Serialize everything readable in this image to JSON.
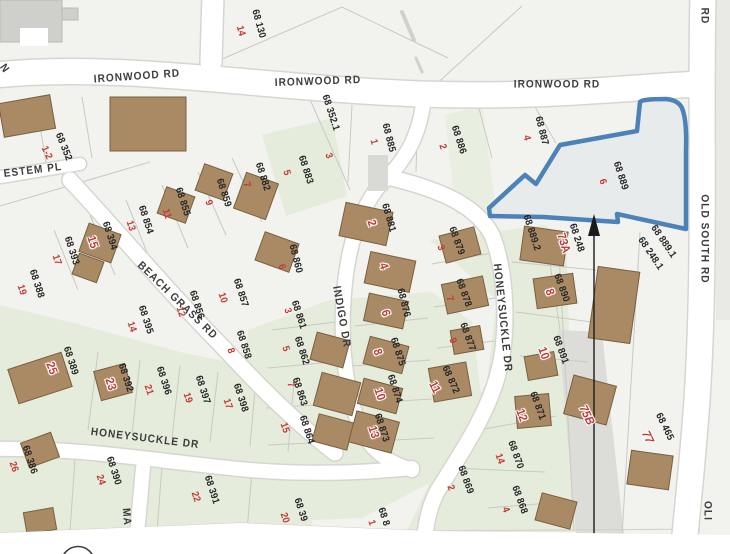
{
  "map": {
    "selected_parcel": {
      "parcel_number": "68 889",
      "house_number": "6"
    },
    "colors": {
      "highlight_blue": "#4d82b8",
      "house_red": "#c13a36",
      "parcel_text": "#262626",
      "street_text": "#3d3d3d",
      "building_brown": "#aa8a64",
      "building_edge": "#77603f",
      "green_area": "#e5ecdb",
      "road_white": "#ffffff",
      "background": "#f2f2ef"
    },
    "streets": [
      {
        "t": "IRONWOOD RD",
        "x": 137,
        "y": 77,
        "r": -4
      },
      {
        "t": "IRONWOOD RD",
        "x": 318,
        "y": 82,
        "r": -2
      },
      {
        "t": "IRONWOOD RD",
        "x": 557,
        "y": 85,
        "r": 0
      },
      {
        "t": "RD",
        "x": 704,
        "y": 16,
        "r": 90
      },
      {
        "t": "OLD SOUTH RD",
        "x": 704,
        "y": 239,
        "r": 90
      },
      {
        "t": "OLI",
        "x": 707,
        "y": 511,
        "r": 90
      },
      {
        "t": "ESTEM PL",
        "x": 33,
        "y": 171,
        "r": -7
      },
      {
        "t": "N",
        "x": 4,
        "y": 69,
        "r": 55
      },
      {
        "t": "BEACH GRASS RD",
        "x": 177,
        "y": 301,
        "r": 44
      },
      {
        "t": "INDIGO DR",
        "x": 341,
        "y": 317,
        "r": 80
      },
      {
        "t": "HONEYSUCKLE DR",
        "x": 145,
        "y": 439,
        "r": 7
      },
      {
        "t": "HONEYSUCKLE DR",
        "x": 502,
        "y": 318,
        "r": 84
      },
      {
        "t": "MA",
        "x": 126,
        "y": 517,
        "r": 85
      }
    ],
    "parcels": [
      {
        "t": "68 130",
        "x": 258,
        "y": 24,
        "r": 75
      },
      {
        "t": "68 352",
        "x": 63,
        "y": 147,
        "r": 68
      },
      {
        "t": "68 352.1",
        "x": 330,
        "y": 113,
        "r": 72
      },
      {
        "t": "68 885",
        "x": 388,
        "y": 138,
        "r": 76
      },
      {
        "t": "68 886",
        "x": 458,
        "y": 140,
        "r": 72
      },
      {
        "t": "68 887",
        "x": 541,
        "y": 131,
        "r": 76
      },
      {
        "t": "68 889",
        "x": 620,
        "y": 176,
        "r": 72
      },
      {
        "t": "68 883",
        "x": 305,
        "y": 170,
        "r": 72
      },
      {
        "t": "68 882",
        "x": 262,
        "y": 177,
        "r": 72
      },
      {
        "t": "68 881",
        "x": 388,
        "y": 218,
        "r": 74
      },
      {
        "t": "68 859",
        "x": 223,
        "y": 193,
        "r": 72
      },
      {
        "t": "68 855",
        "x": 182,
        "y": 202,
        "r": 72
      },
      {
        "t": "68 854",
        "x": 145,
        "y": 220,
        "r": 72
      },
      {
        "t": "68 394",
        "x": 109,
        "y": 236,
        "r": 72
      },
      {
        "t": "68 393",
        "x": 71,
        "y": 251,
        "r": 72
      },
      {
        "t": "68 388",
        "x": 36,
        "y": 284,
        "r": 72
      },
      {
        "t": "68 395",
        "x": 145,
        "y": 320,
        "r": 72
      },
      {
        "t": "68 856",
        "x": 196,
        "y": 305,
        "r": 72
      },
      {
        "t": "68 857",
        "x": 240,
        "y": 293,
        "r": 72
      },
      {
        "t": "68 858",
        "x": 243,
        "y": 345,
        "r": 72
      },
      {
        "t": "68 860",
        "x": 295,
        "y": 259,
        "r": 76
      },
      {
        "t": "68 861",
        "x": 298,
        "y": 315,
        "r": 72
      },
      {
        "t": "68 862",
        "x": 301,
        "y": 351,
        "r": 72
      },
      {
        "t": "68 863",
        "x": 299,
        "y": 392,
        "r": 72
      },
      {
        "t": "68 864",
        "x": 306,
        "y": 430,
        "r": 72
      },
      {
        "t": "68 392",
        "x": 125,
        "y": 378,
        "r": 72
      },
      {
        "t": "68 396",
        "x": 163,
        "y": 381,
        "r": 72
      },
      {
        "t": "68 397",
        "x": 202,
        "y": 390,
        "r": 72
      },
      {
        "t": "68 398",
        "x": 240,
        "y": 398,
        "r": 72
      },
      {
        "t": "68 876",
        "x": 403,
        "y": 303,
        "r": 76
      },
      {
        "t": "68 875",
        "x": 397,
        "y": 352,
        "r": 72
      },
      {
        "t": "68 874",
        "x": 394,
        "y": 389,
        "r": 72
      },
      {
        "t": "68 873",
        "x": 381,
        "y": 428,
        "r": 72
      },
      {
        "t": "68 872",
        "x": 450,
        "y": 380,
        "r": 66
      },
      {
        "t": "68 879",
        "x": 456,
        "y": 241,
        "r": 70
      },
      {
        "t": "68 878",
        "x": 463,
        "y": 293,
        "r": 70
      },
      {
        "t": "68 877",
        "x": 467,
        "y": 337,
        "r": 70
      },
      {
        "t": "68 871",
        "x": 537,
        "y": 406,
        "r": 70
      },
      {
        "t": "68 870",
        "x": 515,
        "y": 455,
        "r": 70
      },
      {
        "t": "68 869",
        "x": 465,
        "y": 480,
        "r": 70
      },
      {
        "t": "68 868",
        "x": 519,
        "y": 500,
        "r": 70
      },
      {
        "t": "68 890",
        "x": 561,
        "y": 288,
        "r": 70
      },
      {
        "t": "68 891",
        "x": 560,
        "y": 350,
        "r": 70
      },
      {
        "t": "68 889.2",
        "x": 531,
        "y": 233,
        "r": 72
      },
      {
        "t": "68 248",
        "x": 576,
        "y": 238,
        "r": 72
      },
      {
        "t": "68 889.1",
        "x": 663,
        "y": 242,
        "r": 56
      },
      {
        "t": "68 248.1",
        "x": 650,
        "y": 254,
        "r": 56
      },
      {
        "t": "68 465",
        "x": 664,
        "y": 427,
        "r": 64
      },
      {
        "t": "68 389",
        "x": 70,
        "y": 361,
        "r": 72
      },
      {
        "t": "68 386",
        "x": 29,
        "y": 460,
        "r": 72
      },
      {
        "t": "68 390",
        "x": 113,
        "y": 471,
        "r": 72
      },
      {
        "t": "68 391",
        "x": 211,
        "y": 490,
        "r": 72
      },
      {
        "t": "68 39",
        "x": 300,
        "y": 510,
        "r": 72
      },
      {
        "t": "68 8",
        "x": 383,
        "y": 517,
        "r": 72
      }
    ],
    "house_numbers": [
      {
        "t": "14",
        "x": 240,
        "y": 31,
        "r": 75
      },
      {
        "t": "1-2",
        "x": 46,
        "y": 153,
        "r": 65
      },
      {
        "t": "3",
        "x": 328,
        "y": 156,
        "r": 70
      },
      {
        "t": "5",
        "x": 286,
        "y": 173,
        "r": 72
      },
      {
        "t": "7",
        "x": 246,
        "y": 185,
        "r": 72
      },
      {
        "t": "1",
        "x": 373,
        "y": 142,
        "r": 76
      },
      {
        "t": "2",
        "x": 442,
        "y": 147,
        "r": 72
      },
      {
        "t": "4",
        "x": 526,
        "y": 138,
        "r": 76
      },
      {
        "t": "6",
        "x": 602,
        "y": 182,
        "r": 72
      },
      {
        "t": "9",
        "x": 208,
        "y": 203,
        "r": 72
      },
      {
        "t": "11",
        "x": 166,
        "y": 214,
        "r": 72
      },
      {
        "t": "13",
        "x": 130,
        "y": 226,
        "r": 72
      },
      {
        "t": "17",
        "x": 56,
        "y": 260,
        "r": 72
      },
      {
        "t": "19",
        "x": 21,
        "y": 290,
        "r": 72
      },
      {
        "t": "14",
        "x": 131,
        "y": 327,
        "r": 72
      },
      {
        "t": "12",
        "x": 180,
        "y": 312,
        "r": 72
      },
      {
        "t": "10",
        "x": 222,
        "y": 298,
        "r": 72
      },
      {
        "t": "8",
        "x": 230,
        "y": 351,
        "r": 72
      },
      {
        "t": "6",
        "x": 281,
        "y": 267,
        "r": 74
      },
      {
        "t": "3",
        "x": 287,
        "y": 311,
        "r": 72
      },
      {
        "t": "5",
        "x": 285,
        "y": 349,
        "r": 72
      },
      {
        "t": "7",
        "x": 290,
        "y": 385,
        "r": 72
      },
      {
        "t": "15",
        "x": 284,
        "y": 428,
        "r": 72
      },
      {
        "t": "21",
        "x": 148,
        "y": 390,
        "r": 72
      },
      {
        "t": "19",
        "x": 187,
        "y": 398,
        "r": 72
      },
      {
        "t": "17",
        "x": 227,
        "y": 404,
        "r": 72
      },
      {
        "t": "3",
        "x": 440,
        "y": 248,
        "r": 70
      },
      {
        "t": "7",
        "x": 449,
        "y": 299,
        "r": 70
      },
      {
        "t": "9",
        "x": 452,
        "y": 341,
        "r": 70
      },
      {
        "t": "26",
        "x": 13,
        "y": 467,
        "r": 72
      },
      {
        "t": "24",
        "x": 100,
        "y": 480,
        "r": 72
      },
      {
        "t": "22",
        "x": 195,
        "y": 497,
        "r": 72
      },
      {
        "t": "20",
        "x": 284,
        "y": 518,
        "r": 72
      },
      {
        "t": "1",
        "x": 371,
        "y": 523,
        "r": 72
      },
      {
        "t": "14",
        "x": 499,
        "y": 459,
        "r": 70
      },
      {
        "t": "2",
        "x": 450,
        "y": 488,
        "r": 70
      },
      {
        "t": "4",
        "x": 505,
        "y": 510,
        "r": 70
      }
    ],
    "house_numbers_on_buildings": [
      {
        "t": "15",
        "x": 93,
        "y": 242,
        "r": 72
      },
      {
        "t": "2",
        "x": 372,
        "y": 223,
        "r": 72
      },
      {
        "t": "4",
        "x": 384,
        "y": 266,
        "r": 72
      },
      {
        "t": "6",
        "x": 386,
        "y": 313,
        "r": 72
      },
      {
        "t": "8",
        "x": 378,
        "y": 352,
        "r": 72
      },
      {
        "t": "10",
        "x": 380,
        "y": 394,
        "r": 72
      },
      {
        "t": "13",
        "x": 374,
        "y": 432,
        "r": 72
      },
      {
        "t": "11",
        "x": 435,
        "y": 387,
        "r": 64
      },
      {
        "t": "23",
        "x": 111,
        "y": 384,
        "r": 72
      },
      {
        "t": "25",
        "x": 52,
        "y": 368,
        "r": 70
      },
      {
        "t": "12",
        "x": 522,
        "y": 415,
        "r": 70
      },
      {
        "t": "8",
        "x": 550,
        "y": 292,
        "r": 70
      },
      {
        "t": "10",
        "x": 544,
        "y": 353,
        "r": 70
      },
      {
        "t": "73A",
        "x": 564,
        "y": 243,
        "r": 72
      }
    ],
    "house_numbers_italic": [
      {
        "t": "75B",
        "x": 587,
        "y": 415,
        "r": 64
      },
      {
        "t": "77",
        "x": 648,
        "y": 437,
        "r": 64
      }
    ]
  }
}
